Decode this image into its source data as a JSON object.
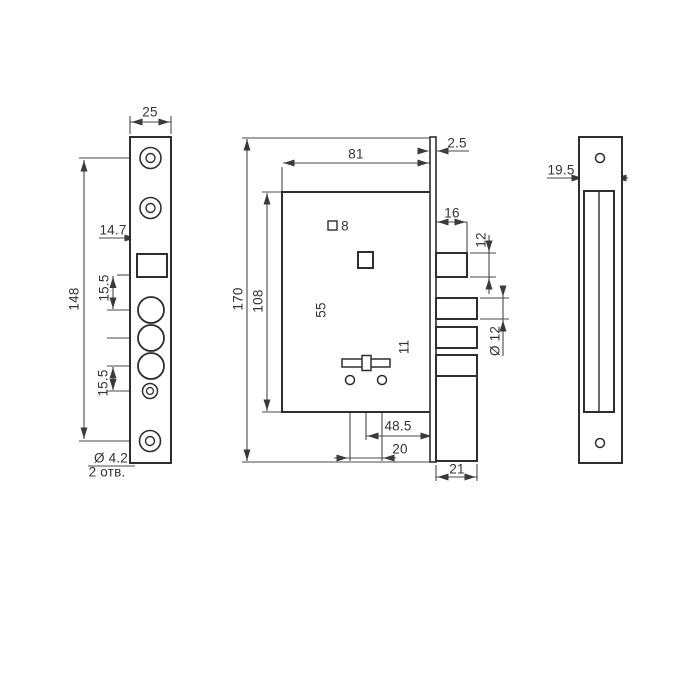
{
  "colors": {
    "line": "#3a3a3a",
    "dim_line": "#4a4a4a",
    "background": "#ffffff"
  },
  "faceplate_view": {
    "width": "25",
    "cutout_offset": "14.7",
    "height": "148",
    "pitch_top": "15.5",
    "pitch_bottom": "15.5",
    "hole_dia": "Ø 4.2",
    "hole_count": "2 отв."
  },
  "body_view": {
    "width": "81",
    "plate_thickness": "2.5",
    "latch_throw": "16",
    "latch_height": "12",
    "spindle_size": "8",
    "height_body": "108",
    "height_total": "170",
    "spindle_to_keyhole": "55",
    "keyhole_to_screws": "11",
    "bolt_dia": "Ø 12",
    "backset": "48.5",
    "screw_pitch": "20",
    "bolt_throw": "21"
  },
  "strike_view": {
    "slot_width": "19.5"
  }
}
